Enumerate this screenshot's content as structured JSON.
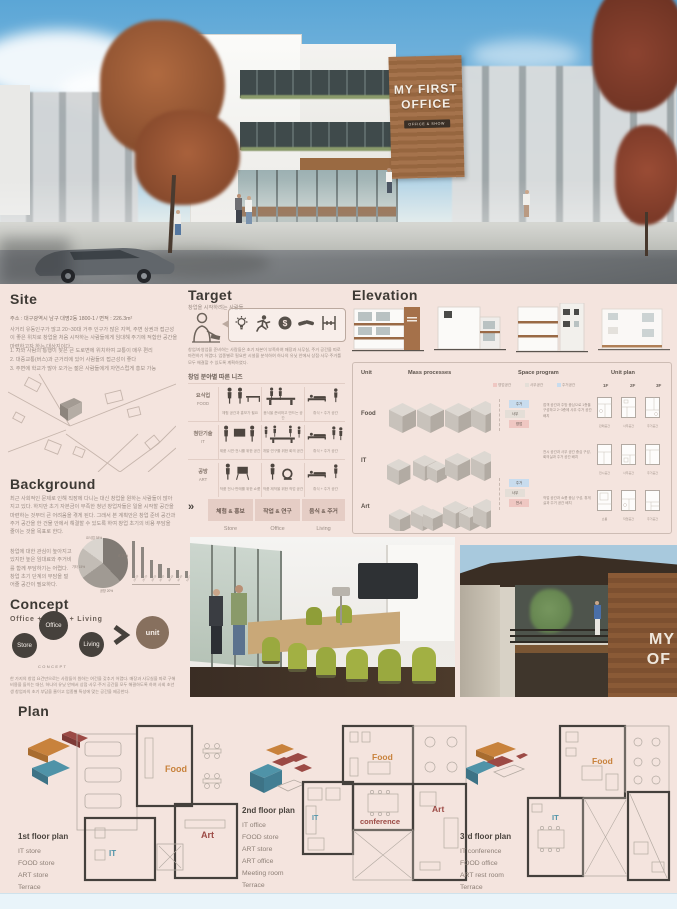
{
  "palette": {
    "board_bg": "#f4e4de",
    "ink": "#3d3934",
    "muted": "#9b8d85",
    "accent_brown": "#8a7160",
    "circle_dark": "#46413c"
  },
  "hero": {
    "sign": {
      "line1": "MY FIRST",
      "line2": "OFFICE",
      "badge": "OFFICE & SHOW"
    }
  },
  "site": {
    "heading": "Site",
    "address": "주소 : 대구광역시 남구 대명2동 1800-1  /  면적 : 226.3m²",
    "para": "사거리 유동인구가 많고 20~30대 거주 인구가 많은 지역, 주변 상권과 접근성이 좋은 위치로 창업을 처음 시작하는 사람들에게 임대해 주기에 적합한 공간을 마련하고자 하는 대상지이다.",
    "notes": [
      "1. 차와 사람의 통행이 잦은 큰 도로변에 위치하여 교통이 매우 편리",
      "2. 대중교통(버스)과 근거리에 있어 사람들의 접근성이 좋다",
      "3. 주변에 학교가 많아 오가는 젊은 사람들에게 자연스럽게 홍보 가능"
    ]
  },
  "target": {
    "heading": "Target",
    "subtitle": "창업을 시작하려는 사람들",
    "para": "창업/자영업을 준비하는 사람들은 초기 자본이 부족하여 매장과 사무실, 주거 공간을 따로 마련하기 어렵다. 업종별로 필요한 시설을 분석하여 하나의 유닛 안에서 상점·사무·주거를 모두 해결할 수 있도록 계획하였다.",
    "needs_title": "창업 분야별 따른 니즈",
    "rows": [
      {
        "ko": "요식업",
        "en": "FOOD",
        "captions": [
          "체험 공간과 홍보가 필요",
          "음식을 준비하고 만드는 공간",
          "휴식 + 주거 공간"
        ]
      },
      {
        "ko": "첨단기술",
        "en": "IT",
        "captions": [
          "제품 시연·전시를 위한 공간",
          "개발·연구를 위한 회의 공간",
          "휴식 + 주거 공간"
        ]
      },
      {
        "ko": "공방",
        "en": "ART",
        "captions": [
          "작품 전시·판매를 위한 쇼룸",
          "작품 제작을 위한 작업 공간",
          "휴식 + 주거 공간"
        ]
      }
    ],
    "summary": {
      "arrow": "»",
      "cells": [
        "체험 & 홍보",
        "작업 & 연구",
        "음식 & 주거"
      ],
      "subs": [
        "Store",
        "Office",
        "Living"
      ]
    }
  },
  "elevation": {
    "heading": "Elevation"
  },
  "unit_table": {
    "headers": {
      "unit": "Unit",
      "mass": "Mass processes",
      "space": "Space program",
      "plan": "Unit plan"
    },
    "floors": [
      "1F",
      "2F",
      "3F"
    ],
    "legend": [
      "영업공간",
      "사무공간",
      "주거공간"
    ],
    "legend_colors": [
      "#efc7c2",
      "#e4ded7",
      "#c8dcee"
    ],
    "rows": [
      {
        "unit": "Food",
        "stack": [
          "주거",
          "사무",
          "영업"
        ],
        "note": "접객 공간과 주방 중심으로 1층을 구성하고 2~3층에 사무·주거 공간 배치",
        "plans": [
          "판매공간",
          "사무공간",
          "주거공간"
        ]
      },
      {
        "unit": "IT",
        "stack": [
          "주거",
          "사무",
          "전시"
        ],
        "note": "전시 공간과 사무 공간 중심 구성, 회의실과 주거 공간 배치",
        "plans": [
          "전시공간",
          "사무공간",
          "주거공간"
        ]
      },
      {
        "unit": "Art",
        "stack": [
          "주거",
          "작업",
          "쇼룸"
        ],
        "note": "작업 공간과 쇼룸 중심 구성, 휴게실과 주거 공간 배치",
        "plans": [
          "쇼룸",
          "작업공간",
          "주거공간"
        ]
      }
    ]
  },
  "background": {
    "heading": "Background",
    "para1": "최근 사회적인 문제로 인해 직장에 다니는 대신 창업을 원하는 사람들이 많아지고 있다. 하지만 초기 자본금이 부족한 청년 창업자들은 일을 시작할 공간을 마련하는 것부터 큰 어려움을 겪게 된다. 그래서 본 계획안은 창업 준비 공간과 주거 공간을 한 건물 안에서 해결할 수 있도록 하여 창업 초기의 비용 부담을 줄이는 것을 목표로 한다.",
    "para2": "창업에 대한 관심이 높아지고 있지만 높은 임대료와 주거비를 함께 부담하기는 어렵다. 창업 초기 단계의 부담을 덜어줄 공간이 필요하다."
  },
  "chart_data": [
    {
      "type": "pie",
      "title": "창업 업종 비율",
      "labels": [
        "요식업 38%",
        "IT 27%",
        "공방 20%",
        "기타 15%"
      ],
      "values": [
        38,
        27,
        20,
        15
      ],
      "legend_position": "inside"
    },
    {
      "type": "bar",
      "title": "연령별 창업 비율",
      "categories": [
        "20-24",
        "25-29",
        "30-34",
        "35-39",
        "40-44",
        "45-49",
        "50-54",
        "55-59",
        "60+"
      ],
      "values": [
        35,
        30,
        17,
        13,
        10,
        8,
        7,
        5,
        4
      ],
      "ylim": [
        0,
        40
      ],
      "grid": false
    }
  ],
  "concept": {
    "heading": "Concept",
    "formula": "Office + Store + Living",
    "circles": [
      "Store",
      "Office",
      "Living"
    ],
    "caption": "CONCEPT",
    "result": "unit",
    "para": "한 가지의 창업 요건만으로는 사람들이 원하는 여건을 갖추기 어렵다. 매장과 사무실을 따로 구해 비용을 들이는 대신, 하나의 유닛 안에서 상점·사무·주거 공간을 모두 해결하도록 하여 사회 초년생 창업자의 초기 부담을 줄이고 업종별 특성에 맞는 공간을 제공한다."
  },
  "photos": {
    "exterior_partial_1": "MY",
    "exterior_partial_2": "OF"
  },
  "plan": {
    "heading": "Plan",
    "colors": {
      "food": "#c8823c",
      "it": "#4f93a8",
      "art": "#9c4a45"
    },
    "groups": [
      {
        "title": "1st floor plan",
        "items": [
          "IT store",
          "FOOD store",
          "ART store",
          "Terrace"
        ],
        "labels": {
          "food": "Food",
          "it": "IT",
          "art": "Art"
        }
      },
      {
        "title": "2nd floor plan",
        "items": [
          "IT office",
          "FOOD store",
          "ART store",
          "ART office",
          "Meeting room",
          "Terrace"
        ],
        "labels": {
          "food": "Food",
          "it": "IT",
          "art": "Art",
          "conf": "conference"
        }
      },
      {
        "title": "3rd floor plan",
        "items": [
          "IT conference",
          "FOOD office",
          "ART rest room",
          "Terrace"
        ],
        "labels": {
          "food": "Food",
          "it": "IT"
        }
      }
    ]
  }
}
